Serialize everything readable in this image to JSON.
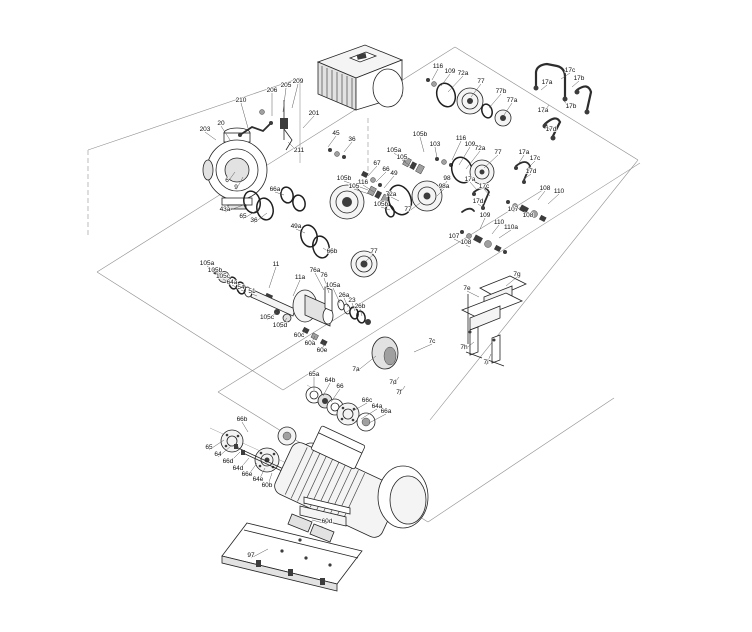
{
  "diagram": {
    "type": "exploded-parts-diagram",
    "colors": {
      "line": "#242424",
      "construction": "#8f8f8f",
      "label": "#101010",
      "background": "#ffffff"
    }
  },
  "labels": [
    {
      "text": "203",
      "x": 205,
      "y": 131,
      "tx": 216,
      "ty": 140
    },
    {
      "text": "20",
      "x": 221,
      "y": 125,
      "tx": 230,
      "ty": 140
    },
    {
      "text": "210",
      "x": 241,
      "y": 102,
      "tx": 248,
      "ty": 128
    },
    {
      "text": "206",
      "x": 272,
      "y": 92,
      "tx": 272,
      "ty": 116
    },
    {
      "text": "205",
      "x": 286,
      "y": 87,
      "tx": 283,
      "ty": 112
    },
    {
      "text": "209",
      "x": 298,
      "y": 83,
      "tx": 292,
      "ty": 108
    },
    {
      "text": "201",
      "x": 314,
      "y": 115,
      "tx": 303,
      "ty": 128
    },
    {
      "text": "211",
      "x": 299,
      "y": 152,
      "tx": 288,
      "ty": 142
    },
    {
      "text": "6",
      "x": 227,
      "y": 182,
      "tx": 235,
      "ty": 172
    },
    {
      "text": "9",
      "x": 236,
      "y": 189,
      "tx": 243,
      "ty": 177
    },
    {
      "text": "43a",
      "x": 225,
      "y": 211,
      "tx": 246,
      "ty": 204
    },
    {
      "text": "65",
      "x": 243,
      "y": 218,
      "tx": 259,
      "ty": 209
    },
    {
      "text": "36",
      "x": 254,
      "y": 222,
      "tx": 267,
      "ty": 213
    },
    {
      "text": "66a",
      "x": 275,
      "y": 191,
      "tx": 284,
      "ty": 195
    },
    {
      "text": "45",
      "x": 336,
      "y": 135,
      "tx": 328,
      "ty": 147
    },
    {
      "text": "36",
      "x": 352,
      "y": 141,
      "tx": 344,
      "ty": 152
    },
    {
      "text": "67",
      "x": 377,
      "y": 165,
      "tx": 368,
      "ty": 176
    },
    {
      "text": "66",
      "x": 386,
      "y": 171,
      "tx": 376,
      "ty": 182
    },
    {
      "text": "49",
      "x": 394,
      "y": 175,
      "tx": 384,
      "ty": 188
    },
    {
      "text": "105b",
      "x": 344,
      "y": 180,
      "tx": 368,
      "ty": 190
    },
    {
      "text": "116",
      "x": 363,
      "y": 184,
      "tx": 374,
      "ty": 192
    },
    {
      "text": "105",
      "x": 354,
      "y": 188,
      "tx": 372,
      "ty": 195
    },
    {
      "text": "72a",
      "x": 391,
      "y": 196,
      "tx": 399,
      "ty": 201
    },
    {
      "text": "77",
      "x": 408,
      "y": 211,
      "tx": 420,
      "ty": 203
    },
    {
      "text": "105b",
      "x": 381,
      "y": 206,
      "tx": 390,
      "ty": 210
    },
    {
      "text": "98",
      "x": 447,
      "y": 180,
      "tx": 441,
      "ty": 190
    },
    {
      "text": "98a",
      "x": 444,
      "y": 188,
      "tx": 437,
      "ty": 196
    },
    {
      "text": "17a",
      "x": 470,
      "y": 181,
      "tx": 477,
      "ty": 190
    },
    {
      "text": "17c",
      "x": 484,
      "y": 188,
      "tx": 490,
      "ty": 196
    },
    {
      "text": "17d",
      "x": 478,
      "y": 203,
      "tx": 484,
      "ty": 208
    },
    {
      "text": "105a",
      "x": 394,
      "y": 152,
      "tx": 406,
      "ty": 162
    },
    {
      "text": "105",
      "x": 402,
      "y": 159,
      "tx": 412,
      "ty": 167
    },
    {
      "text": "105b",
      "x": 420,
      "y": 136,
      "tx": 424,
      "ty": 152
    },
    {
      "text": "103",
      "x": 435,
      "y": 146,
      "tx": 437,
      "ty": 158
    },
    {
      "text": "116",
      "x": 461,
      "y": 140,
      "tx": 452,
      "ty": 160
    },
    {
      "text": "109",
      "x": 470,
      "y": 146,
      "tx": 459,
      "ty": 165
    },
    {
      "text": "72a",
      "x": 480,
      "y": 150,
      "tx": 466,
      "ty": 169
    },
    {
      "text": "77",
      "x": 498,
      "y": 154,
      "tx": 484,
      "ty": 168
    },
    {
      "text": "116",
      "x": 438,
      "y": 68,
      "tx": 432,
      "ty": 80
    },
    {
      "text": "109",
      "x": 450,
      "y": 73,
      "tx": 441,
      "ty": 86
    },
    {
      "text": "72a",
      "x": 463,
      "y": 75,
      "tx": 448,
      "ty": 92
    },
    {
      "text": "77",
      "x": 481,
      "y": 83,
      "tx": 471,
      "ty": 97
    },
    {
      "text": "77b",
      "x": 501,
      "y": 93,
      "tx": 489,
      "ty": 108
    },
    {
      "text": "77a",
      "x": 512,
      "y": 102,
      "tx": 504,
      "ty": 115
    },
    {
      "text": "17a",
      "x": 547,
      "y": 84,
      "tx": 541,
      "ty": 90
    },
    {
      "text": "17c",
      "x": 570,
      "y": 72,
      "tx": 561,
      "ty": 79
    },
    {
      "text": "17b",
      "x": 579,
      "y": 80,
      "tx": 572,
      "ty": 87
    },
    {
      "text": "17a",
      "x": 543,
      "y": 112,
      "tx": 549,
      "ty": 105
    },
    {
      "text": "17b",
      "x": 571,
      "y": 108,
      "tx": 564,
      "ty": 101
    },
    {
      "text": "17d",
      "x": 551,
      "y": 131,
      "tx": 546,
      "ty": 123
    },
    {
      "text": "17a",
      "x": 524,
      "y": 154,
      "tx": 519,
      "ty": 163
    },
    {
      "text": "17c",
      "x": 535,
      "y": 160,
      "tx": 528,
      "ty": 168
    },
    {
      "text": "17d",
      "x": 531,
      "y": 173,
      "tx": 524,
      "ty": 179
    },
    {
      "text": "108",
      "x": 545,
      "y": 190,
      "tx": 538,
      "ty": 200
    },
    {
      "text": "110",
      "x": 559,
      "y": 193,
      "tx": 548,
      "ty": 204
    },
    {
      "text": "107",
      "x": 513,
      "y": 211,
      "tx": 521,
      "ty": 207
    },
    {
      "text": "108",
      "x": 528,
      "y": 217,
      "tx": 534,
      "ty": 212
    },
    {
      "text": "109",
      "x": 485,
      "y": 217,
      "tx": 480,
      "ty": 229
    },
    {
      "text": "110",
      "x": 499,
      "y": 224,
      "tx": 492,
      "ty": 234
    },
    {
      "text": "110a",
      "x": 511,
      "y": 229,
      "tx": 499,
      "ty": 238
    },
    {
      "text": "107",
      "x": 454,
      "y": 238,
      "tx": 462,
      "ty": 243
    },
    {
      "text": "108",
      "x": 466,
      "y": 244,
      "tx": 470,
      "ty": 247
    },
    {
      "text": "49a",
      "x": 296,
      "y": 228,
      "tx": 305,
      "ty": 233
    },
    {
      "text": "66b",
      "x": 332,
      "y": 253,
      "tx": 323,
      "ty": 248
    },
    {
      "text": "105a",
      "x": 207,
      "y": 265,
      "tx": 214,
      "ty": 271
    },
    {
      "text": "105b",
      "x": 215,
      "y": 272,
      "tx": 222,
      "ty": 277
    },
    {
      "text": "105c",
      "x": 223,
      "y": 278,
      "tx": 230,
      "ty": 283
    },
    {
      "text": "64a",
      "x": 232,
      "y": 284,
      "tx": 238,
      "ty": 288
    },
    {
      "text": "54",
      "x": 241,
      "y": 289,
      "tx": 246,
      "ty": 292
    },
    {
      "text": "51",
      "x": 252,
      "y": 293,
      "tx": 257,
      "ty": 296
    },
    {
      "text": "11",
      "x": 276,
      "y": 266,
      "tx": 269,
      "ty": 288
    },
    {
      "text": "11a",
      "x": 300,
      "y": 279,
      "tx": 293,
      "ty": 296
    },
    {
      "text": "76a",
      "x": 315,
      "y": 272,
      "tx": 324,
      "ty": 290
    },
    {
      "text": "76",
      "x": 324,
      "y": 277,
      "tx": 329,
      "ty": 293
    },
    {
      "text": "105a",
      "x": 333,
      "y": 287,
      "tx": 340,
      "ty": 303
    },
    {
      "text": "26a",
      "x": 344,
      "y": 297,
      "tx": 348,
      "ty": 307
    },
    {
      "text": "23",
      "x": 352,
      "y": 302,
      "tx": 355,
      "ty": 311
    },
    {
      "text": "26b",
      "x": 360,
      "y": 308,
      "tx": 362,
      "ty": 316
    },
    {
      "text": "105c",
      "x": 267,
      "y": 319,
      "tx": 277,
      "ty": 312
    },
    {
      "text": "105d",
      "x": 280,
      "y": 327,
      "tx": 287,
      "ty": 318
    },
    {
      "text": "60c",
      "x": 299,
      "y": 337,
      "tx": 306,
      "ty": 330
    },
    {
      "text": "60a",
      "x": 310,
      "y": 345,
      "tx": 315,
      "ty": 336
    },
    {
      "text": "60e",
      "x": 322,
      "y": 352,
      "tx": 324,
      "ty": 342
    },
    {
      "text": "77",
      "x": 374,
      "y": 253,
      "tx": 366,
      "ty": 261
    },
    {
      "text": "7a",
      "x": 356,
      "y": 371,
      "tx": 376,
      "ty": 356
    },
    {
      "text": "7c",
      "x": 432,
      "y": 343,
      "tx": 414,
      "ty": 352
    },
    {
      "text": "7d",
      "x": 393,
      "y": 384,
      "tx": 399,
      "ty": 377
    },
    {
      "text": "7f",
      "x": 399,
      "y": 394,
      "tx": 405,
      "ty": 386
    },
    {
      "text": "7e",
      "x": 467,
      "y": 290,
      "tx": 479,
      "ty": 297
    },
    {
      "text": "7g",
      "x": 517,
      "y": 276,
      "tx": 506,
      "ty": 286
    },
    {
      "text": "7h",
      "x": 464,
      "y": 349,
      "tx": 474,
      "ty": 342
    },
    {
      "text": "7i",
      "x": 486,
      "y": 364,
      "tx": 491,
      "ty": 354
    },
    {
      "text": "65a",
      "x": 314,
      "y": 376,
      "tx": 314,
      "ty": 390
    },
    {
      "text": "64b",
      "x": 330,
      "y": 382,
      "tx": 323,
      "ty": 396
    },
    {
      "text": "66",
      "x": 340,
      "y": 388,
      "tx": 331,
      "ty": 402
    },
    {
      "text": "66c",
      "x": 367,
      "y": 402,
      "tx": 351,
      "ty": 412
    },
    {
      "text": "64a",
      "x": 377,
      "y": 408,
      "tx": 361,
      "ty": 419
    },
    {
      "text": "66a",
      "x": 386,
      "y": 413,
      "tx": 369,
      "ty": 423
    },
    {
      "text": "66b",
      "x": 242,
      "y": 421,
      "tx": 248,
      "ty": 432
    },
    {
      "text": "65",
      "x": 209,
      "y": 449,
      "tx": 224,
      "ty": 440
    },
    {
      "text": "64",
      "x": 218,
      "y": 456,
      "tx": 231,
      "ty": 446
    },
    {
      "text": "66d",
      "x": 228,
      "y": 463,
      "tx": 240,
      "ty": 452
    },
    {
      "text": "64d",
      "x": 238,
      "y": 470,
      "tx": 249,
      "ty": 458
    },
    {
      "text": "66e",
      "x": 247,
      "y": 476,
      "tx": 257,
      "ty": 463
    },
    {
      "text": "64e",
      "x": 258,
      "y": 481,
      "tx": 265,
      "ty": 468
    },
    {
      "text": "60b",
      "x": 267,
      "y": 487,
      "tx": 272,
      "ty": 473
    },
    {
      "text": "60d",
      "x": 327,
      "y": 523,
      "tx": 312,
      "ty": 520
    },
    {
      "text": "97",
      "x": 251,
      "y": 557,
      "tx": 268,
      "ty": 549
    }
  ]
}
